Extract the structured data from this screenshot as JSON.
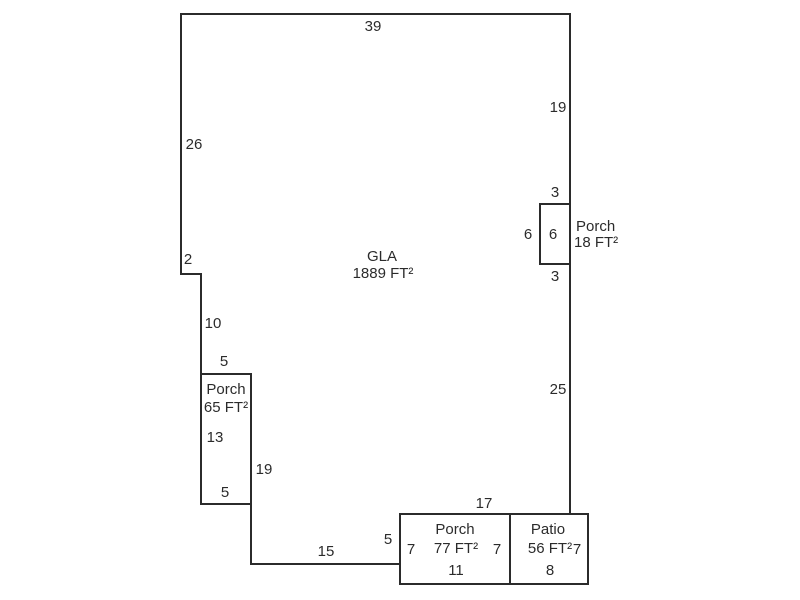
{
  "sketch": {
    "background_color": "#ffffff",
    "line_color": "#2b2b2b",
    "text_color": "#2b2b2b",
    "areas": {
      "gla": {
        "label": "GLA",
        "area": "1889 FT²"
      },
      "porch_right": {
        "label": "Porch",
        "area": "18 FT²"
      },
      "porch_left": {
        "label": "Porch",
        "area": "65 FT²"
      },
      "porch_bottom": {
        "label": "Porch",
        "area": "77 FT²"
      },
      "patio": {
        "label": "Patio",
        "area": "56 FT²"
      }
    },
    "dimensions": {
      "top_width": "39",
      "right_upper": "19",
      "left_upper": "26",
      "left_step": "2",
      "porch_right_top": "3",
      "porch_right_width_outer": "6",
      "porch_right_width_inner": "6",
      "porch_right_bottom": "3",
      "right_lower": "25",
      "left_mid": "10",
      "porch_left_top": "5",
      "porch_left_height": "13",
      "left_lower": "19",
      "porch_left_bottom": "5",
      "bottom_right": "17",
      "bottom_step": "5",
      "bottom_mid": "15",
      "porch_bottom_left_height": "7",
      "porch_bottom_right_height": "7",
      "porch_bottom_width": "11",
      "patio_height": "7",
      "patio_width": "8"
    }
  }
}
